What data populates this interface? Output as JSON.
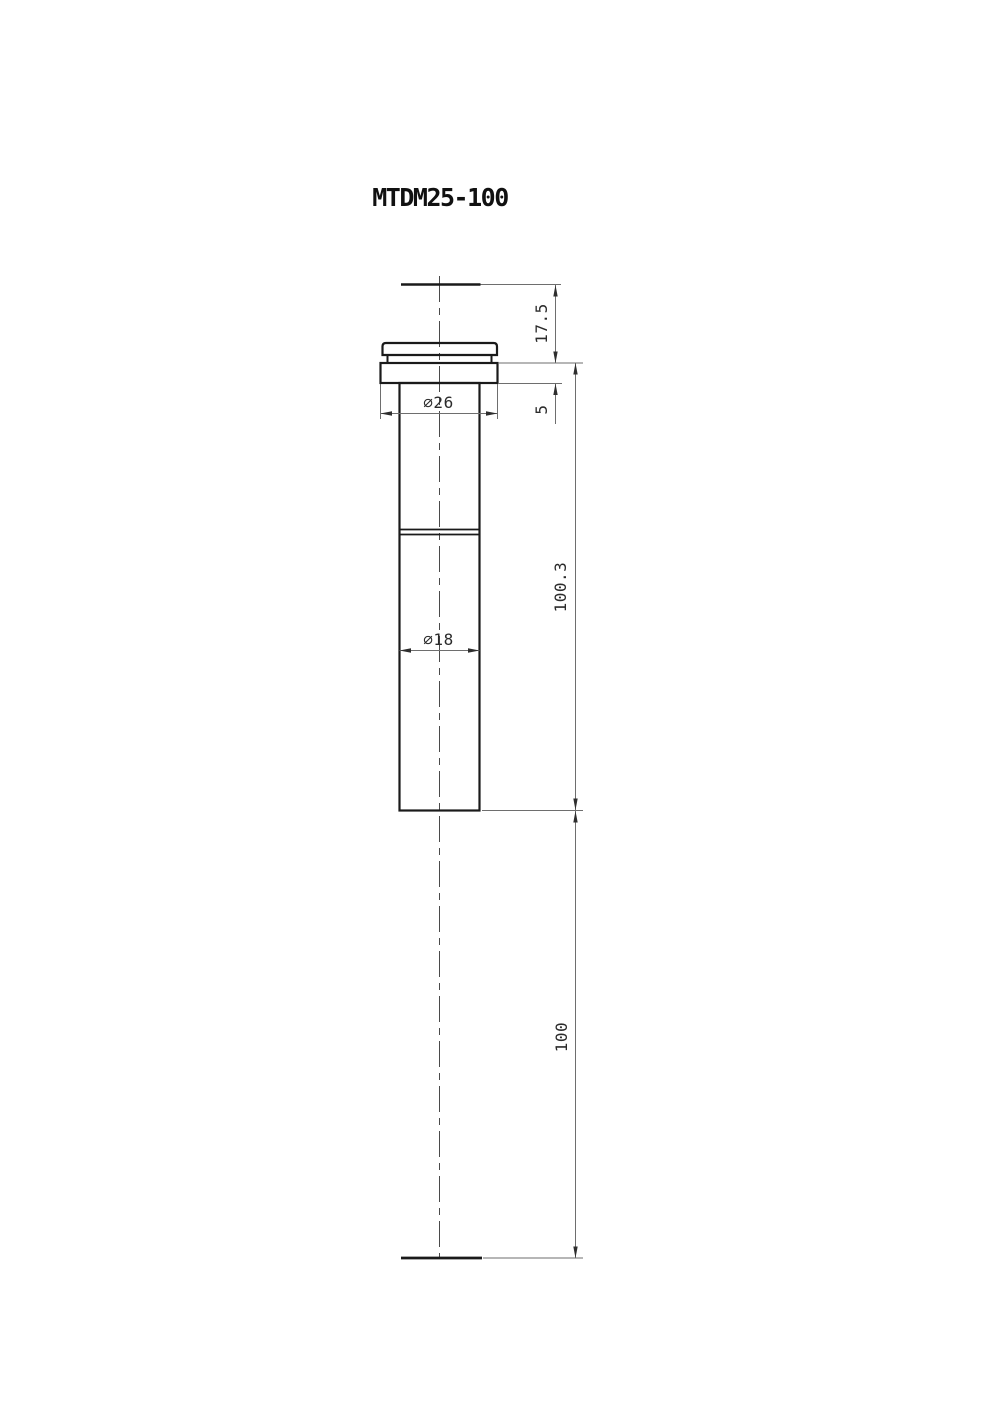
{
  "title": "MTDM25-100",
  "drawing": {
    "type": "technical-drawing",
    "view": "side-elevation",
    "labels": {
      "dim_top_to_flange": "17.5",
      "dim_flange_thickness": "5",
      "dim_flange_to_tip": "100.3",
      "dim_working_distance": "100",
      "dim_flange_diameter": "⌀26",
      "dim_body_diameter": "⌀18"
    },
    "colors": {
      "background": "#ffffff",
      "object_line": "#1a1a1a",
      "dimension_line": "#6e6e6e",
      "center_line": "#4a4a4a",
      "text": "#2b2b2b"
    }
  }
}
